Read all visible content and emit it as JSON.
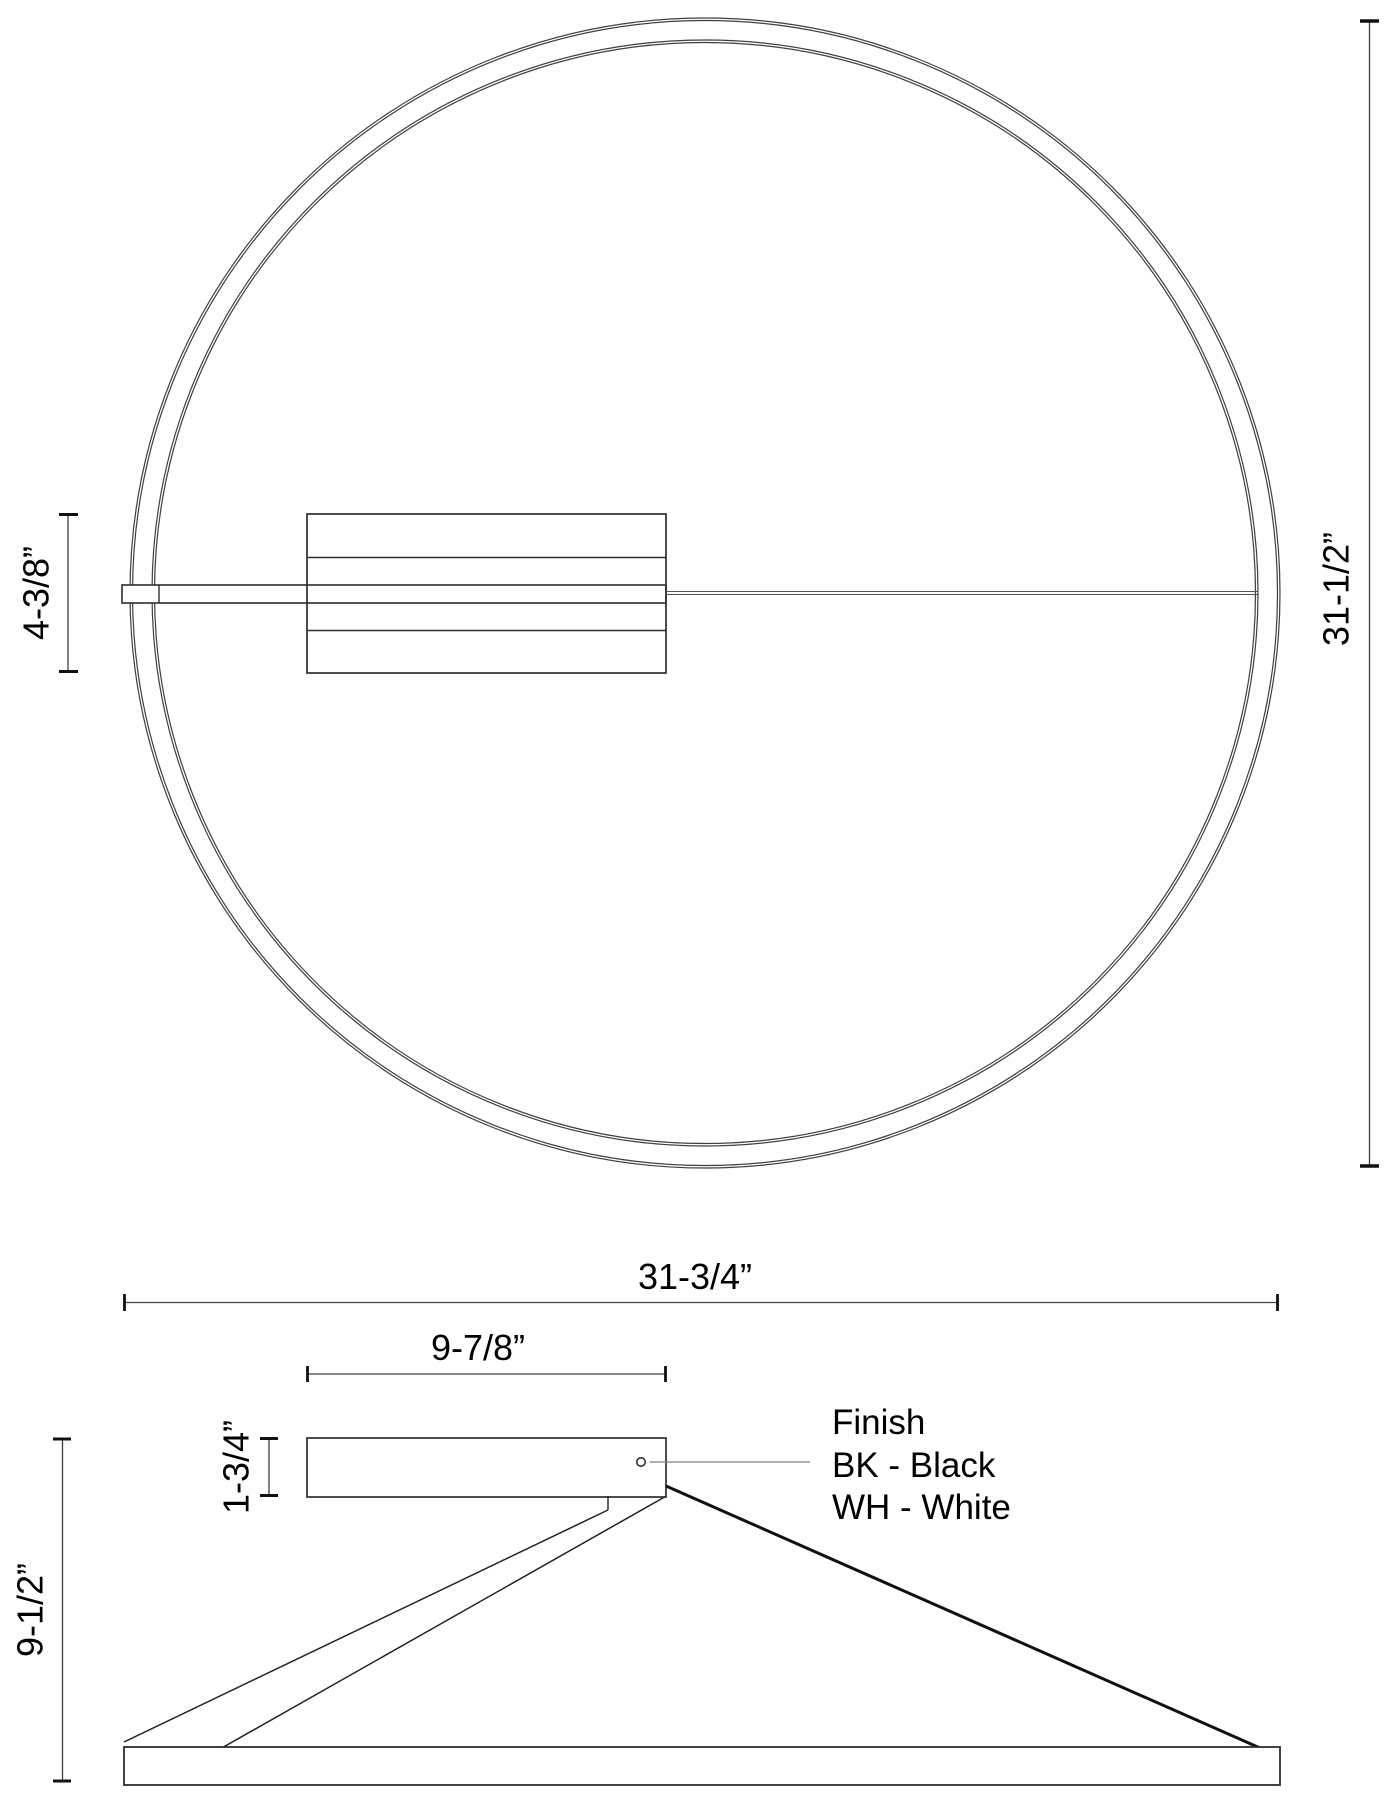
{
  "drawing": {
    "type": "fixture-spec-drawing",
    "background": "#ffffff"
  },
  "colors": {
    "line": "#3f3f3f",
    "edge": "#2e2e2e",
    "tick": "#111111",
    "leader": "#7f7f7f",
    "centerline": "#555555",
    "text": "#000000"
  },
  "top_view": {
    "labels": {
      "plate_height": "4-3/8”",
      "ring_diameter": "31-1/2”"
    }
  },
  "side_view": {
    "labels": {
      "overall_width": "31-3/4”",
      "canopy_width": "9-7/8”",
      "canopy_height": "1-3/4”",
      "overall_height": "9-1/2”"
    },
    "finish": {
      "title": "Finish",
      "option_black": "BK - Black",
      "option_white": "WH - White"
    }
  }
}
